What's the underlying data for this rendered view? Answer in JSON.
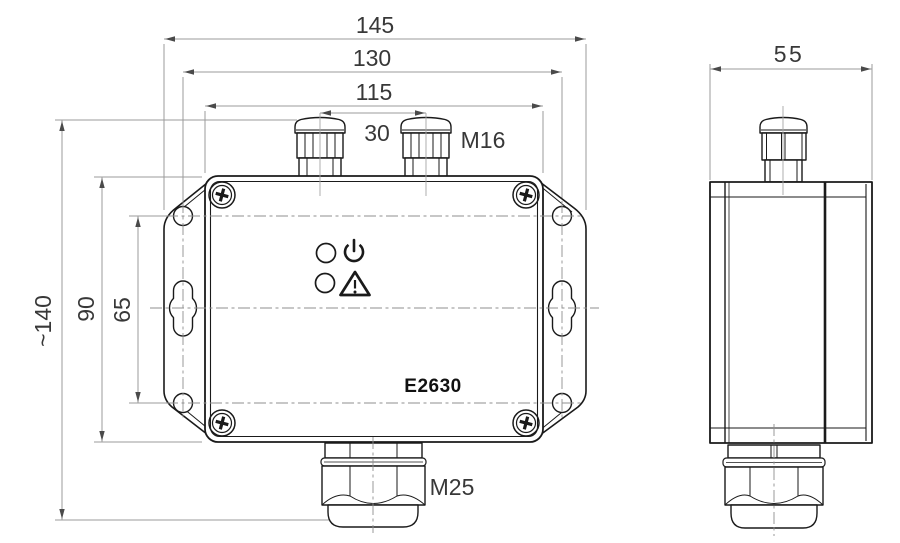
{
  "drawing": {
    "product_label": "E2630",
    "views": {
      "front": {
        "name": "front view",
        "led_indicators": [
          {
            "icon": "power-icon",
            "symbol": "power"
          },
          {
            "icon": "warning-icon",
            "symbol": "warning"
          }
        ],
        "screw_count": 4,
        "mounting_slots": 2
      },
      "side": {
        "name": "side view"
      }
    },
    "dimensions": {
      "overall_width": "145",
      "mounting_hole_spacing_horizontal": "130",
      "body_width": "115",
      "gland_spacing": "30",
      "top_gland_thread": "M16",
      "overall_height": "~140",
      "body_height": "90",
      "mounting_hole_spacing_vertical": "65",
      "bottom_gland_thread": "M25",
      "depth": "55"
    },
    "colors": {
      "part_line": "#1a1a1a",
      "dimension_line": "#9b9b9b",
      "dimension_text": "#383838",
      "background": "#ffffff"
    }
  }
}
